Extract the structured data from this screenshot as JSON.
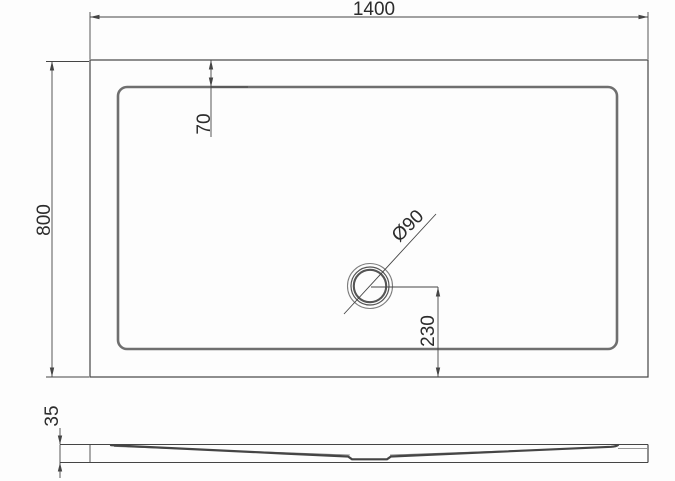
{
  "dims": {
    "overall_width": "1400",
    "overall_depth": "800",
    "rim_inset_top": "70",
    "drain_diameter": "Ø90",
    "drain_to_edge": "230",
    "tray_height": "35"
  },
  "colors": {
    "background": "#fdfdfd",
    "line": "#454545",
    "rim": "#6f6f6f",
    "text": "#2c2c2c"
  }
}
